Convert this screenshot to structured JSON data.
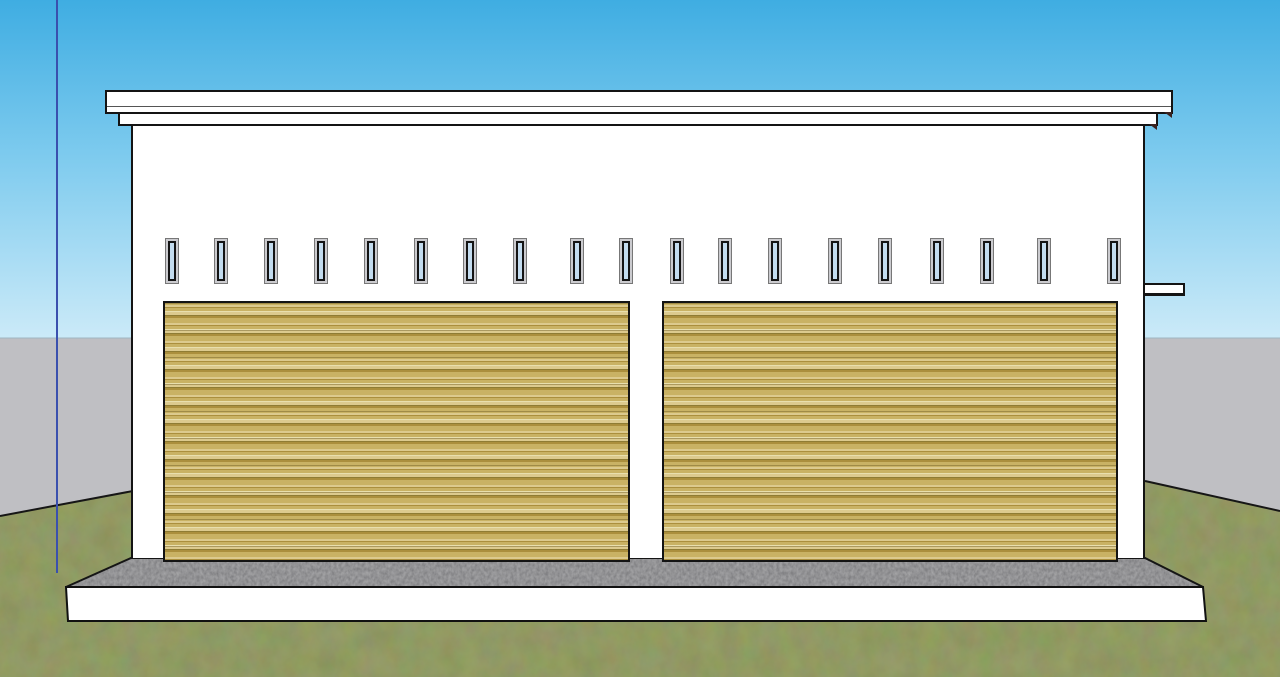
{
  "scene": {
    "viewport": {
      "width": 1280,
      "height": 677,
      "horizon_y": 338
    },
    "colors": {
      "sky_top": "#3fade2",
      "sky_mid": "#7ccaee",
      "sky_bottom": "#cbeaf8",
      "backdrop_gray": "#bfbfc3",
      "grass_green": "#45501f",
      "concrete_gray": "#454547",
      "white": "#ffffff",
      "edge_black": "#141414",
      "axis_blue": "#3a50ae",
      "window_glass": "#c3dcef",
      "window_frame_outer": "#cbcbcf",
      "window_frame_inner": "#141414",
      "door_s1": "#c9b264",
      "door_s2": "#dcca8e",
      "door_s3": "#ab8f3d",
      "door_s4": "#e8dfae",
      "door_s5": "#8f7c34"
    },
    "building": {
      "name": "two-bay-garage-front-elevation",
      "window_count": 19,
      "door_count": 2
    },
    "windows": {
      "y": 238,
      "width": 14,
      "height": 46,
      "positions_x": [
        165,
        214,
        264,
        314,
        364,
        414,
        463,
        513,
        570,
        619,
        670,
        718,
        768,
        828,
        878,
        930,
        980,
        1037,
        1107
      ]
    }
  }
}
